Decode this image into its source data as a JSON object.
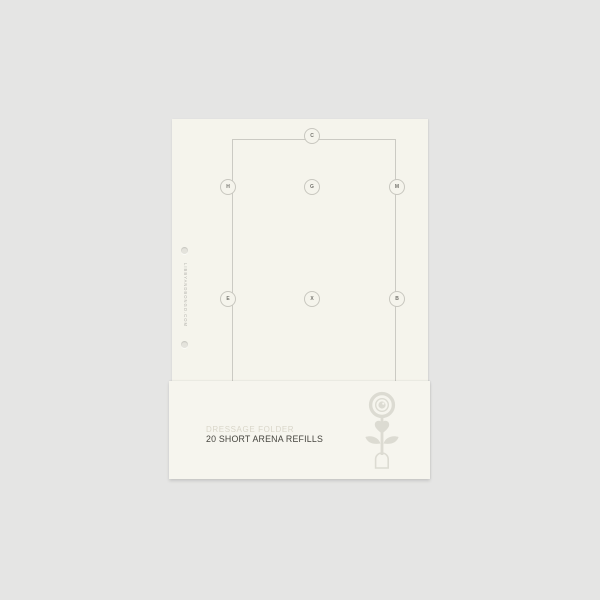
{
  "colors": {
    "background": "#e5e5e4",
    "paper": "#f5f4ec",
    "band": "#f6f5ee",
    "arena_line": "#cbcac3",
    "marker_border": "#c8c7bf",
    "marker_text": "#74736d",
    "hole_fill": "#e4e3dc",
    "spine_text": "#b4b3ad",
    "series_text": "#d9d6c9",
    "title_text": "#46453f",
    "logo": "#dcdbd2"
  },
  "page": {
    "spine_url": "LIBBYANDBONGO.COM",
    "arena": {
      "markers": [
        "C",
        "H",
        "G",
        "M",
        "E",
        "X",
        "B"
      ]
    }
  },
  "band": {
    "series": "DRESSAGE FOLDER",
    "title": "20 SHORT ARENA REFILLS"
  }
}
